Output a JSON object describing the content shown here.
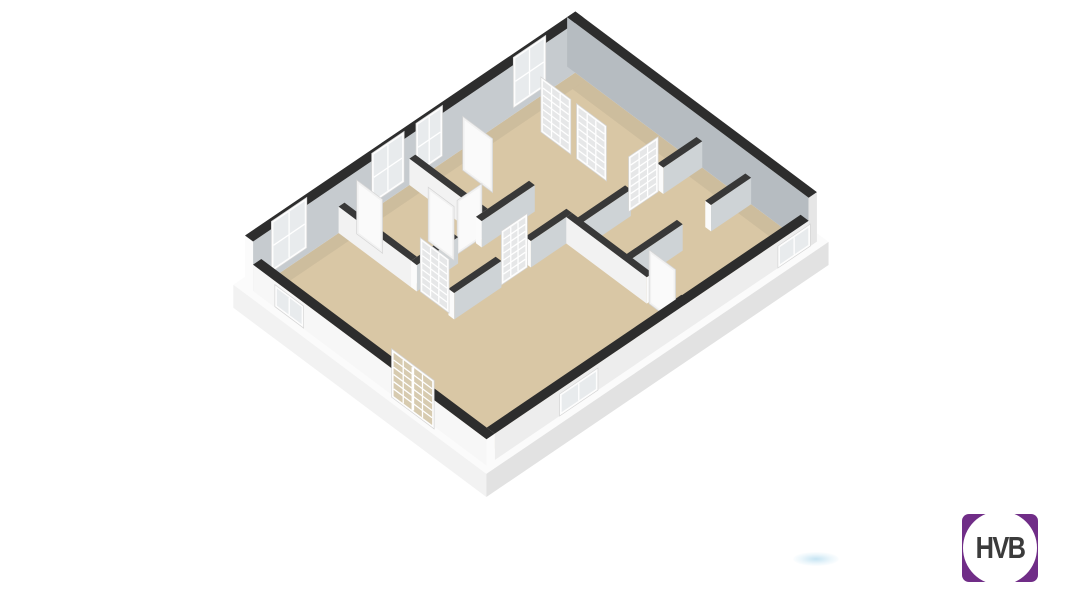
{
  "logo": {
    "text": "HVB",
    "purple": "#702d87",
    "text_color": "#3b3b3b",
    "circle_color": "#ffffff"
  },
  "scene": {
    "type": "3d-floorplan-cutaway-render",
    "background": "#ffffff",
    "smudge_color": "rgba(150,205,232,0.5)"
  },
  "floorplan": {
    "projection": {
      "origin": [
        245,
        285
      ],
      "u": [
        0.59,
        -0.4
      ],
      "v": [
        0.575,
        0.43
      ],
      "hs": 0.55
    },
    "palette": {
      "floor": "#d9c7a5",
      "floor_shadow": "rgba(60,60,60,0.07)",
      "wall_top": "#2d2d2d",
      "wall_top_interior": "#383838",
      "inner_gray": "#c6cbcf",
      "inner_gray_dark": "#b6bcc1",
      "int_face_gray": "#ced3d6",
      "int_face_white": "#f2f2f2",
      "face_white": "#f7f7f7",
      "face_lighter": "#ededed",
      "cap_white": "#fbfbfb",
      "slab_top": "#fbfbfb",
      "slab_left": "#f2f2f2",
      "slab_right": "#e2e2e2",
      "frame": "#fdfdfd",
      "frame_stroke": "#d5d5d5",
      "pane_window": "#e8ebed",
      "pane_glass_door": "rgba(150,155,160,0.22)",
      "pane_entrance": "#d7cbb0",
      "door_face": "#f1f1f1",
      "door_panel": "#fafafa",
      "grid_line": "#ffffff"
    },
    "elements": [
      {
        "type": "top",
        "id": "slab-top",
        "u1": -10,
        "v1": -10,
        "u2": 570,
        "v2": 430,
        "h": 0,
        "fill": "slab_top"
      },
      {
        "type": "faceV",
        "id": "slab-left-face",
        "u": -10,
        "v1": -10,
        "v2": 430,
        "h0": -42,
        "h1": 0,
        "fill": "slab_left"
      },
      {
        "type": "faceU",
        "id": "slab-front-face",
        "v": 430,
        "u1": -10,
        "u2": 570,
        "h0": -42,
        "h1": 0,
        "fill": "slab_right"
      },
      {
        "type": "top",
        "id": "floor",
        "u1": 14,
        "v1": 14,
        "u2": 546,
        "v2": 406,
        "h": 0,
        "fill": "floor"
      },
      {
        "type": "top",
        "id": "floor-shadow-back",
        "u1": 14,
        "v1": 14,
        "u2": 546,
        "v2": 32,
        "h": 0,
        "fill": "floor_shadow"
      },
      {
        "type": "top",
        "id": "floor-shadow-right",
        "u1": 524,
        "v1": 32,
        "u2": 546,
        "v2": 406,
        "h": 0,
        "fill": "floor_shadow"
      },
      {
        "type": "wall",
        "id": "facade-back-left",
        "axis": "u",
        "u1": 0,
        "u2": 560,
        "v1": 0,
        "v2": 14,
        "h": 90,
        "face": "inner_gray",
        "top": "wall_top",
        "cap": "cap_white"
      },
      {
        "type": "panel",
        "id": "window-back-1",
        "orient": "u",
        "at": 10,
        "a": 35,
        "b": 95,
        "h0": 6,
        "h1": 98,
        "cols": 2,
        "rows": 2,
        "pane": "pane_window"
      },
      {
        "type": "panel",
        "id": "window-back-2",
        "orient": "u",
        "at": 10,
        "a": 205,
        "b": 260,
        "h0": 6,
        "h1": 98,
        "cols": 2,
        "rows": 2,
        "pane": "pane_window"
      },
      {
        "type": "panel",
        "id": "window-back-3",
        "orient": "u",
        "at": 10,
        "a": 280,
        "b": 325,
        "h0": 6,
        "h1": 98,
        "cols": 2,
        "rows": 2,
        "pane": "pane_window"
      },
      {
        "type": "panel",
        "id": "window-back-4",
        "orient": "u",
        "at": 10,
        "a": 445,
        "b": 500,
        "h0": 6,
        "h1": 98,
        "cols": 2,
        "rows": 2,
        "pane": "pane_window"
      },
      {
        "type": "wall",
        "id": "facade-back-right",
        "axis": "v",
        "u1": 546,
        "u2": 560,
        "v1": 0,
        "v2": 420,
        "h": 90,
        "face": "inner_gray_dark",
        "top": "wall_top",
        "cap": "#e6e6e6"
      },
      {
        "type": "wall",
        "id": "wall-bedroom-divider-2",
        "axis": "v",
        "u1": 265,
        "u2": 275,
        "v1": 14,
        "v2": 140,
        "h": 48,
        "face": "int_face_white",
        "top": "wall_top_interior",
        "cap": "cap_white"
      },
      {
        "type": "wall",
        "id": "wall-bedroom-divider-1",
        "axis": "v",
        "u1": 145,
        "u2": 155,
        "v1": 14,
        "v2": 140,
        "h": 48,
        "face": "int_face_white",
        "top": "wall_top_interior",
        "cap": "cap_white"
      },
      {
        "type": "panel",
        "id": "door-open-1",
        "orient": "v",
        "at": 160,
        "a": 30,
        "b": 75,
        "h0": 0,
        "h1": 98,
        "cols": 0,
        "frame": "door_face"
      },
      {
        "type": "panel",
        "id": "door-open-2",
        "orient": "v",
        "at": 330,
        "a": 40,
        "b": 92,
        "h0": 0,
        "h1": 98,
        "cols": 0,
        "frame": "door_face"
      },
      {
        "type": "panel",
        "id": "door-open-3",
        "orient": "u",
        "at": 138,
        "a": 225,
        "b": 267,
        "h0": 0,
        "h1": 98,
        "cols": 0,
        "frame": "door_face"
      },
      {
        "type": "wall",
        "id": "wall-hall-north-a",
        "axis": "u",
        "u1": 145,
        "u2": 215,
        "v1": 140,
        "v2": 150,
        "h": 48,
        "face": "int_face_gray",
        "top": "wall_top_interior",
        "cap": "cap_white"
      },
      {
        "type": "wall",
        "id": "wall-hall-north-b",
        "axis": "u",
        "u1": 255,
        "u2": 345,
        "v1": 140,
        "v2": 150,
        "h": 48,
        "face": "int_face_gray",
        "top": "wall_top_interior",
        "cap": "cap_white"
      },
      {
        "type": "panel",
        "id": "door-hall-north",
        "orient": "v",
        "at": 215,
        "a": 98,
        "b": 143,
        "h0": 0,
        "h1": 98,
        "cols": 0,
        "frame": "door_face"
      },
      {
        "type": "panel",
        "id": "glazed-door-1",
        "orient": "v",
        "at": 445,
        "a": 58,
        "b": 110,
        "h0": 0,
        "h1": 100,
        "cols": 3,
        "rows": 7,
        "pane": "pane_glass_door"
      },
      {
        "type": "panel",
        "id": "glazed-door-2",
        "orient": "v",
        "at": 445,
        "a": 120,
        "b": 172,
        "h0": 0,
        "h1": 100,
        "cols": 3,
        "rows": 7,
        "pane": "pane_glass_door"
      },
      {
        "type": "wall",
        "id": "wall-right-split-1a",
        "axis": "u",
        "u1": 340,
        "u2": 425,
        "v1": 225,
        "v2": 235,
        "h": 48,
        "face": "int_face_gray",
        "top": "wall_top_interior",
        "cap": "cap_white"
      },
      {
        "type": "wall",
        "id": "wall-right-split-1b",
        "axis": "u",
        "u1": 480,
        "u2": 546,
        "v1": 225,
        "v2": 235,
        "h": 48,
        "face": "int_face_gray",
        "top": "wall_top_interior",
        "cap": "cap_white"
      },
      {
        "type": "panel",
        "id": "glazed-door-3",
        "orient": "u",
        "at": 228,
        "a": 428,
        "b": 478,
        "h0": 0,
        "h1": 100,
        "cols": 3,
        "rows": 7,
        "pane": "pane_glass_door"
      },
      {
        "type": "wall",
        "id": "wall-hall-south-a",
        "axis": "u",
        "u1": 145,
        "u2": 225,
        "v1": 205,
        "v2": 215,
        "h": 48,
        "face": "int_face_gray",
        "top": "wall_top_interior",
        "cap": "cap_white"
      },
      {
        "type": "wall",
        "id": "wall-hall-south-b",
        "axis": "u",
        "u1": 275,
        "u2": 345,
        "v1": 205,
        "v2": 215,
        "h": 48,
        "face": "int_face_gray",
        "top": "wall_top_interior",
        "cap": "cap_white"
      },
      {
        "type": "panel",
        "id": "glazed-door-hall-living",
        "orient": "u",
        "at": 212,
        "a": 228,
        "b": 272,
        "h0": 0,
        "h1": 98,
        "cols": 3,
        "rows": 7,
        "pane": "pane_glass_door"
      },
      {
        "type": "panel",
        "id": "glazed-door-hall-west",
        "orient": "v",
        "at": 148,
        "a": 153,
        "b": 203,
        "h0": 0,
        "h1": 98,
        "cols": 3,
        "rows": 7,
        "pane": "pane_glass_door"
      },
      {
        "type": "wall",
        "id": "wall-right-split-2a",
        "axis": "u",
        "u1": 340,
        "u2": 430,
        "v1": 310,
        "v2": 320,
        "h": 48,
        "face": "int_face_gray",
        "top": "wall_top_interior",
        "cap": "cap_white"
      },
      {
        "type": "wall",
        "id": "wall-right-split-2b",
        "axis": "u",
        "u1": 478,
        "u2": 546,
        "v1": 310,
        "v2": 320,
        "h": 48,
        "face": "int_face_gray",
        "top": "wall_top_interior",
        "cap": "cap_white"
      },
      {
        "type": "wall",
        "id": "wall-living-east-a",
        "axis": "v",
        "u1": 335,
        "u2": 345,
        "v1": 215,
        "v2": 355,
        "h": 48,
        "face": "int_face_white",
        "top": "wall_top_interior",
        "cap": "cap_white"
      },
      {
        "type": "wall",
        "id": "wall-living-east-b",
        "axis": "v",
        "u1": 335,
        "u2": 345,
        "v1": 405,
        "v2": 420,
        "h": 48,
        "face": "int_face_white",
        "top": "wall_top_interior",
        "cap": "cap_white"
      },
      {
        "type": "panel",
        "id": "door-living-east",
        "orient": "v",
        "at": 337,
        "a": 357,
        "b": 403,
        "h0": 0,
        "h1": 98,
        "cols": 0,
        "frame": "door_face"
      },
      {
        "type": "wall",
        "id": "facade-front-right",
        "axis": "u",
        "u1": 14,
        "u2": 546,
        "v1": 406,
        "v2": 420,
        "h": 48,
        "face": "face_lighter",
        "top": "wall_top",
        "cap": "cap_white"
      },
      {
        "type": "panel",
        "id": "window-front-right-1",
        "orient": "u",
        "at": 424,
        "a": 120,
        "b": 185,
        "h0": 6,
        "h1": 46,
        "cols": 2,
        "rows": 1,
        "pane": "pane_window"
      },
      {
        "type": "panel",
        "id": "window-front-right-2",
        "orient": "u",
        "at": 424,
        "a": 490,
        "b": 545,
        "h0": 6,
        "h1": 46,
        "cols": 2,
        "rows": 1,
        "pane": "pane_window"
      },
      {
        "type": "wall",
        "id": "facade-front-left",
        "axis": "v",
        "u1": 0,
        "u2": 14,
        "v1": 14,
        "v2": 420,
        "h": 48,
        "face": "face_white",
        "top": "wall_top",
        "cap": "cap_white"
      },
      {
        "type": "panel",
        "id": "window-front-left-1",
        "orient": "v",
        "at": -3,
        "a": 55,
        "b": 105,
        "h0": 6,
        "h1": 46,
        "cols": 2,
        "rows": 1,
        "pane": "pane_window"
      },
      {
        "type": "panel",
        "id": "entrance-glazed-doors",
        "orient": "v",
        "at": -3,
        "a": 258,
        "b": 332,
        "h0": 0,
        "h1": 88,
        "cols": 4,
        "rows": 6,
        "pane": "pane_entrance",
        "stile": true
      }
    ]
  }
}
